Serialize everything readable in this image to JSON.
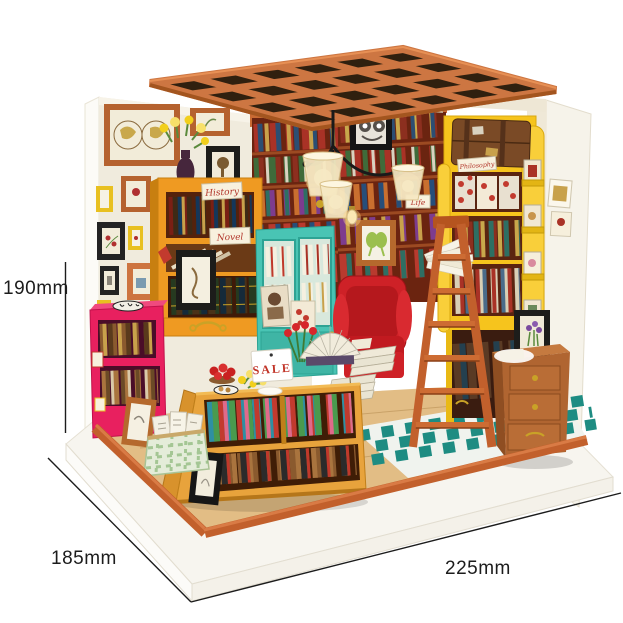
{
  "meta": {
    "description": "DIY miniature dollhouse bookstore room kit product photo with size annotations"
  },
  "dimensions": {
    "height_label": "190mm",
    "depth_label": "185mm",
    "width_label": "225mm"
  },
  "signs": {
    "software": "Software",
    "popular": "Popular",
    "history": "History",
    "novel": "Novel",
    "life": "Life",
    "philosophy": "Philosophy",
    "sale": "SALE"
  },
  "colors": {
    "background": "#ffffff",
    "annotation": "#1c1c1c",
    "roof_wood": "#cd7642",
    "wall_cream": "#f0ebdd",
    "shelf_orange": "#ef9a22",
    "shelf_pink": "#e8205f",
    "cabinet_teal": "#49c4b4",
    "armchair_red": "#ce2127",
    "shelf_yellow": "#f6c41d",
    "ladder_wood": "#c2602c",
    "floor_teal": "#1e8c82",
    "table_wood": "#e8a33c",
    "back_shelf_wood": "#6b2410",
    "sale_text": "#c13327"
  }
}
